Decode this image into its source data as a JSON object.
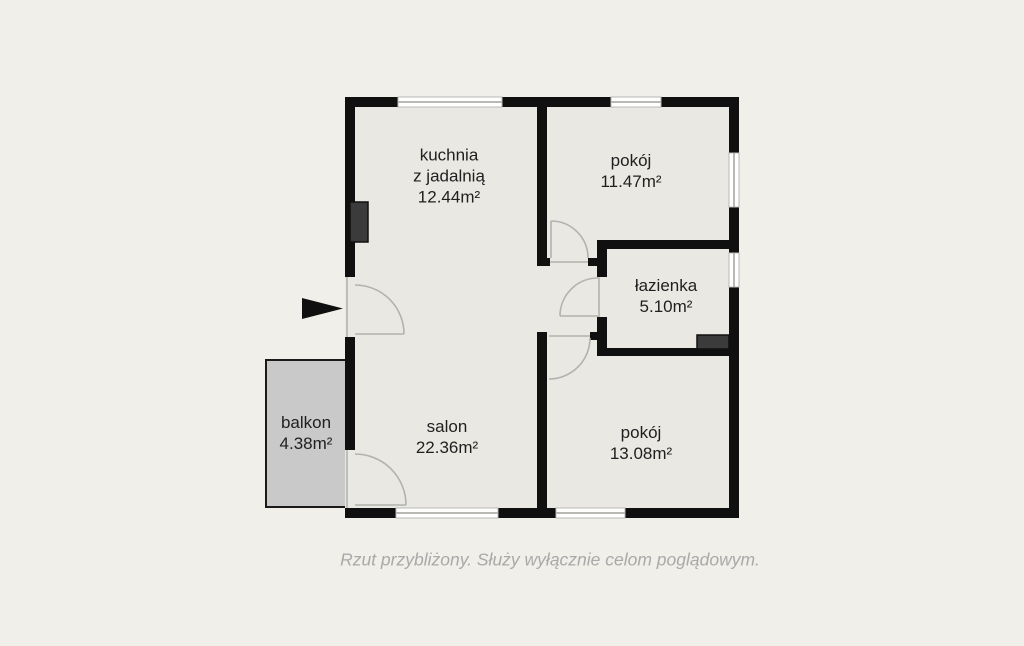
{
  "colors": {
    "background": "#f0efea",
    "floor": "#e9e8e3",
    "wall": "#101010",
    "balcony_fill": "#c9c9c9",
    "balcony_border": "#1a1a1a",
    "shaft_fill": "#3b3b3b",
    "window_fill": "#ffffff",
    "window_frame": "#b9b8b4",
    "door_line": "#b3b2ae",
    "label_text": "#1f1f1f",
    "caption_text": "#a9a9a9"
  },
  "rooms": {
    "kuchnia": {
      "name_line1": "kuchnia",
      "name_line2": "z jadalnią",
      "area": "12.44m²"
    },
    "pokoj_gorny": {
      "name": "pokój",
      "area": "11.47m²"
    },
    "lazienka": {
      "name": "łazienka",
      "area": "5.10m²"
    },
    "salon": {
      "name": "salon",
      "area": "22.36m²"
    },
    "pokoj_dolny": {
      "name": "pokój",
      "area": "13.08m²"
    },
    "balkon": {
      "name": "balkon",
      "area": "4.38m²"
    }
  },
  "caption": "Rzut przybliżony. Służy wyłącznie celom poglądowym."
}
